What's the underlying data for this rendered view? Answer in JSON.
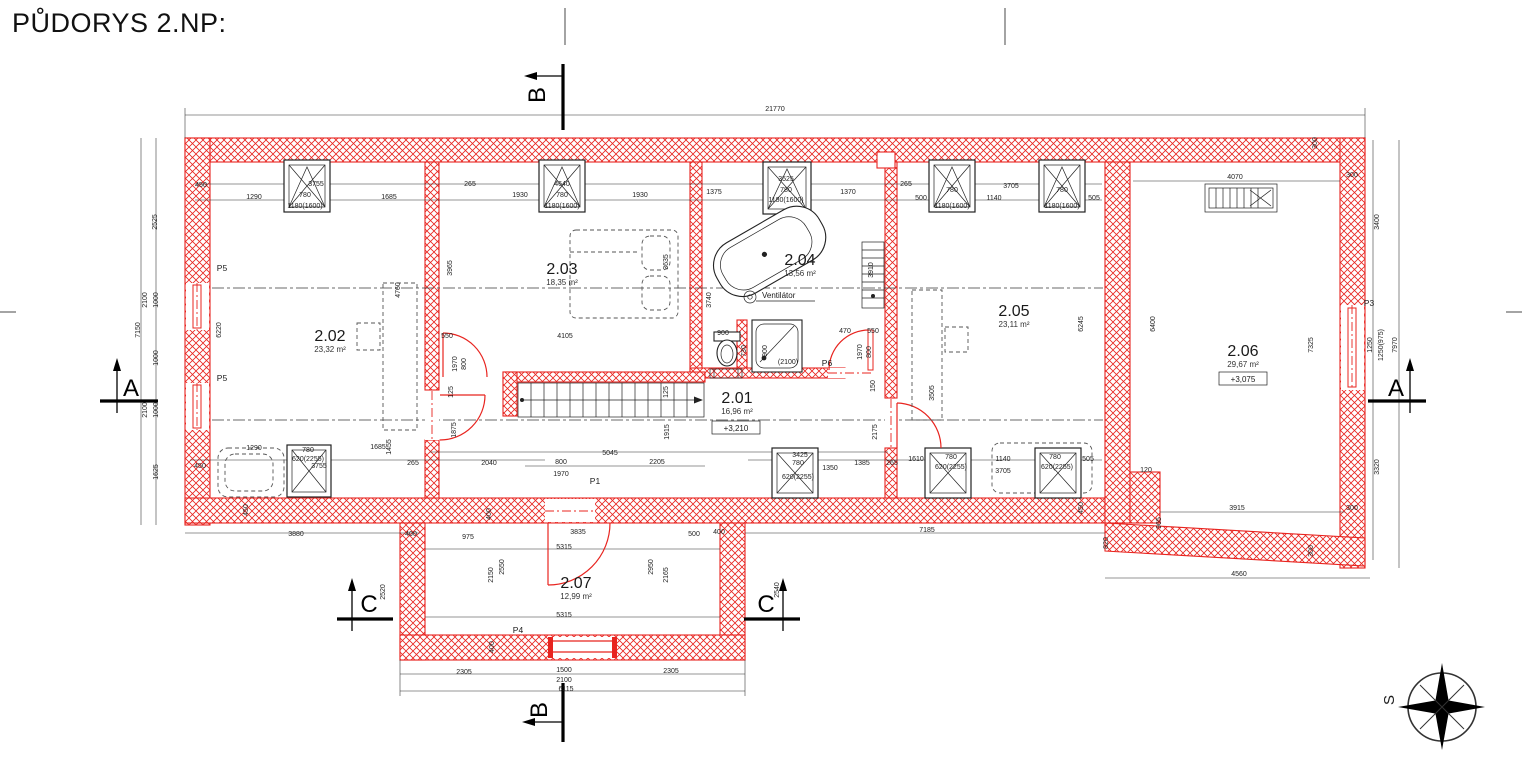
{
  "title": "PŮDORYS 2.NP:",
  "rooms": [
    {
      "number": "2.01",
      "area": "16,96 m²",
      "elevation": "+3,210"
    },
    {
      "number": "2.02",
      "area": "23,32 m²"
    },
    {
      "number": "2.03",
      "area": "18,35 m²"
    },
    {
      "number": "2.04",
      "area": "13,56 m²"
    },
    {
      "number": "2.05",
      "area": "23,11 m²"
    },
    {
      "number": "2.06",
      "area": "29,67 m²",
      "elevation": "+3,075"
    },
    {
      "number": "2.07",
      "area": "12,99 m²"
    }
  ],
  "labels": {
    "ventilator": "Ventilátor"
  },
  "compass": {
    "north_label": "S"
  },
  "sections": [
    {
      "letter": "A"
    },
    {
      "letter": "A"
    },
    {
      "letter": "B"
    },
    {
      "letter": "B"
    },
    {
      "letter": "C"
    },
    {
      "letter": "C"
    }
  ],
  "door_labels": [
    [
      "P5",
      222,
      271
    ],
    [
      "P5",
      222,
      381
    ],
    [
      "P1",
      595,
      484
    ],
    [
      "P6",
      827,
      366
    ],
    [
      "P3",
      1369,
      306
    ],
    [
      "P4",
      518,
      633
    ]
  ],
  "dimensions": [
    [
      "21770",
      775,
      111,
      0
    ],
    [
      "450",
      201,
      187,
      0
    ],
    [
      "1290",
      254,
      199,
      0
    ],
    [
      "3755",
      316,
      186,
      0
    ],
    [
      "780",
      305,
      197,
      0
    ],
    [
      "1180(1600)",
      305,
      208,
      0
    ],
    [
      "1685",
      389,
      199,
      0
    ],
    [
      "265",
      470,
      186,
      0
    ],
    [
      "1930",
      520,
      197,
      0
    ],
    [
      "4640",
      562,
      186,
      0
    ],
    [
      "780",
      562,
      197,
      0
    ],
    [
      "1180(1600)",
      562,
      208,
      0
    ],
    [
      "1930",
      640,
      197,
      0
    ],
    [
      "1375",
      714,
      194,
      0
    ],
    [
      "3525",
      786,
      181,
      0
    ],
    [
      "780",
      786,
      192,
      0
    ],
    [
      "1180(1600)",
      786,
      202,
      0
    ],
    [
      "1370",
      848,
      194,
      0
    ],
    [
      "265",
      906,
      186,
      0
    ],
    [
      "500",
      921,
      200,
      0
    ],
    [
      "780",
      952,
      192,
      0
    ],
    [
      "1180(1600)",
      952,
      208,
      0
    ],
    [
      "1140",
      994,
      200,
      0
    ],
    [
      "3705",
      1011,
      188,
      0
    ],
    [
      "780",
      1062,
      192,
      0
    ],
    [
      "1180(1600)",
      1062,
      208,
      0
    ],
    [
      "505",
      1094,
      200,
      0
    ],
    [
      "4070",
      1235,
      179,
      0
    ],
    [
      "300",
      1317,
      143,
      1
    ],
    [
      "300",
      1352,
      177,
      0
    ],
    [
      "7150",
      140,
      330,
      1
    ],
    [
      "2525",
      157,
      222,
      1
    ],
    [
      "2100",
      147,
      300,
      1
    ],
    [
      "1000",
      158,
      300,
      1
    ],
    [
      "1000",
      158,
      358,
      1
    ],
    [
      "2100",
      147,
      410,
      1
    ],
    [
      "1000",
      158,
      410,
      1
    ],
    [
      "1625",
      158,
      472,
      1
    ],
    [
      "6220",
      221,
      330,
      1
    ],
    [
      "3400",
      1379,
      222,
      1
    ],
    [
      "1250",
      1372,
      345,
      1
    ],
    [
      "1250(975)",
      1383,
      345,
      1
    ],
    [
      "7970",
      1397,
      345,
      1
    ],
    [
      "3320",
      1379,
      467,
      1
    ],
    [
      "300",
      1313,
      551,
      1
    ],
    [
      "965",
      1161,
      523,
      1
    ],
    [
      "120",
      1146,
      472,
      0
    ],
    [
      "3915",
      1237,
      510,
      0
    ],
    [
      "300",
      1352,
      510,
      0
    ],
    [
      "4560",
      1239,
      576,
      0
    ],
    [
      "820",
      1108,
      543,
      1
    ],
    [
      "6400",
      1155,
      324,
      1
    ],
    [
      "7325",
      1313,
      345,
      1
    ],
    [
      "6245",
      1083,
      324,
      1
    ],
    [
      "3965",
      452,
      268,
      1
    ],
    [
      "4760",
      400,
      290,
      1
    ],
    [
      "3635",
      668,
      262,
      1
    ],
    [
      "4105",
      565,
      338,
      0
    ],
    [
      "3740",
      711,
      300,
      1
    ],
    [
      "3910",
      873,
      270,
      1
    ],
    [
      "550",
      447,
      338,
      0
    ],
    [
      "1970",
      457,
      364,
      1
    ],
    [
      "800",
      466,
      364,
      1
    ],
    [
      "125",
      453,
      392,
      1
    ],
    [
      "900",
      723,
      335,
      0
    ],
    [
      "730",
      746,
      351,
      1
    ],
    [
      "900",
      767,
      351,
      1
    ],
    [
      "(2100)",
      788,
      364,
      0
    ],
    [
      "470",
      845,
      333,
      0
    ],
    [
      "550",
      873,
      333,
      0
    ],
    [
      "1970",
      862,
      352,
      1
    ],
    [
      "800",
      871,
      352,
      1
    ],
    [
      "150",
      875,
      386,
      1
    ],
    [
      "2175",
      877,
      432,
      1
    ],
    [
      "125",
      668,
      392,
      1
    ],
    [
      "1915",
      669,
      432,
      1
    ],
    [
      "5045",
      610,
      455,
      0
    ],
    [
      "800",
      561,
      464,
      0
    ],
    [
      "1970",
      561,
      476,
      0
    ],
    [
      "2205",
      657,
      464,
      0
    ],
    [
      "1350",
      830,
      470,
      0
    ],
    [
      "3425",
      800,
      457,
      0
    ],
    [
      "780",
      798,
      465,
      0
    ],
    [
      "620(2255)",
      798,
      479,
      0
    ],
    [
      "1385",
      862,
      465,
      0
    ],
    [
      "265",
      892,
      465,
      0
    ],
    [
      "1610",
      916,
      461,
      0
    ],
    [
      "780",
      951,
      459,
      0
    ],
    [
      "620(2255)",
      951,
      469,
      0
    ],
    [
      "1140",
      1003,
      461,
      0
    ],
    [
      "3705",
      1003,
      473,
      0
    ],
    [
      "780",
      1055,
      459,
      0
    ],
    [
      "620(2255)",
      1057,
      469,
      0
    ],
    [
      "505",
      1088,
      461,
      0
    ],
    [
      "450",
      1083,
      508,
      1
    ],
    [
      "7185",
      927,
      532,
      0
    ],
    [
      "3505",
      934,
      393,
      1
    ],
    [
      "1875",
      456,
      430,
      1
    ],
    [
      "1455",
      391,
      447,
      1
    ],
    [
      "450",
      200,
      468,
      0
    ],
    [
      "1290",
      254,
      450,
      0
    ],
    [
      "780",
      308,
      452,
      0
    ],
    [
      "620(2255)",
      308,
      461,
      0
    ],
    [
      "3755",
      319,
      468,
      0
    ],
    [
      "1685",
      378,
      449,
      0
    ],
    [
      "265",
      413,
      465,
      0
    ],
    [
      "2040",
      489,
      465,
      0
    ],
    [
      "450",
      248,
      510,
      1
    ],
    [
      "3880",
      296,
      536,
      0
    ],
    [
      "400",
      411,
      536,
      0
    ],
    [
      "975",
      468,
      539,
      0
    ],
    [
      "400",
      491,
      514,
      1
    ],
    [
      "3835",
      578,
      534,
      0
    ],
    [
      "500",
      694,
      536,
      0
    ],
    [
      "400",
      719,
      534,
      0
    ],
    [
      "5315",
      564,
      549,
      0
    ],
    [
      "2550",
      504,
      567,
      1
    ],
    [
      "2150",
      493,
      575,
      1
    ],
    [
      "2950",
      653,
      567,
      1
    ],
    [
      "2165",
      668,
      575,
      1
    ],
    [
      "5315",
      564,
      617,
      0
    ],
    [
      "400",
      494,
      647,
      1
    ],
    [
      "2305",
      464,
      674,
      0
    ],
    [
      "1500",
      564,
      672,
      0
    ],
    [
      "2305",
      671,
      673,
      0
    ],
    [
      "2100",
      564,
      682,
      0
    ],
    [
      "6115",
      566,
      691,
      0
    ],
    [
      "2520",
      385,
      592,
      1
    ],
    [
      "2540",
      779,
      590,
      1
    ]
  ]
}
